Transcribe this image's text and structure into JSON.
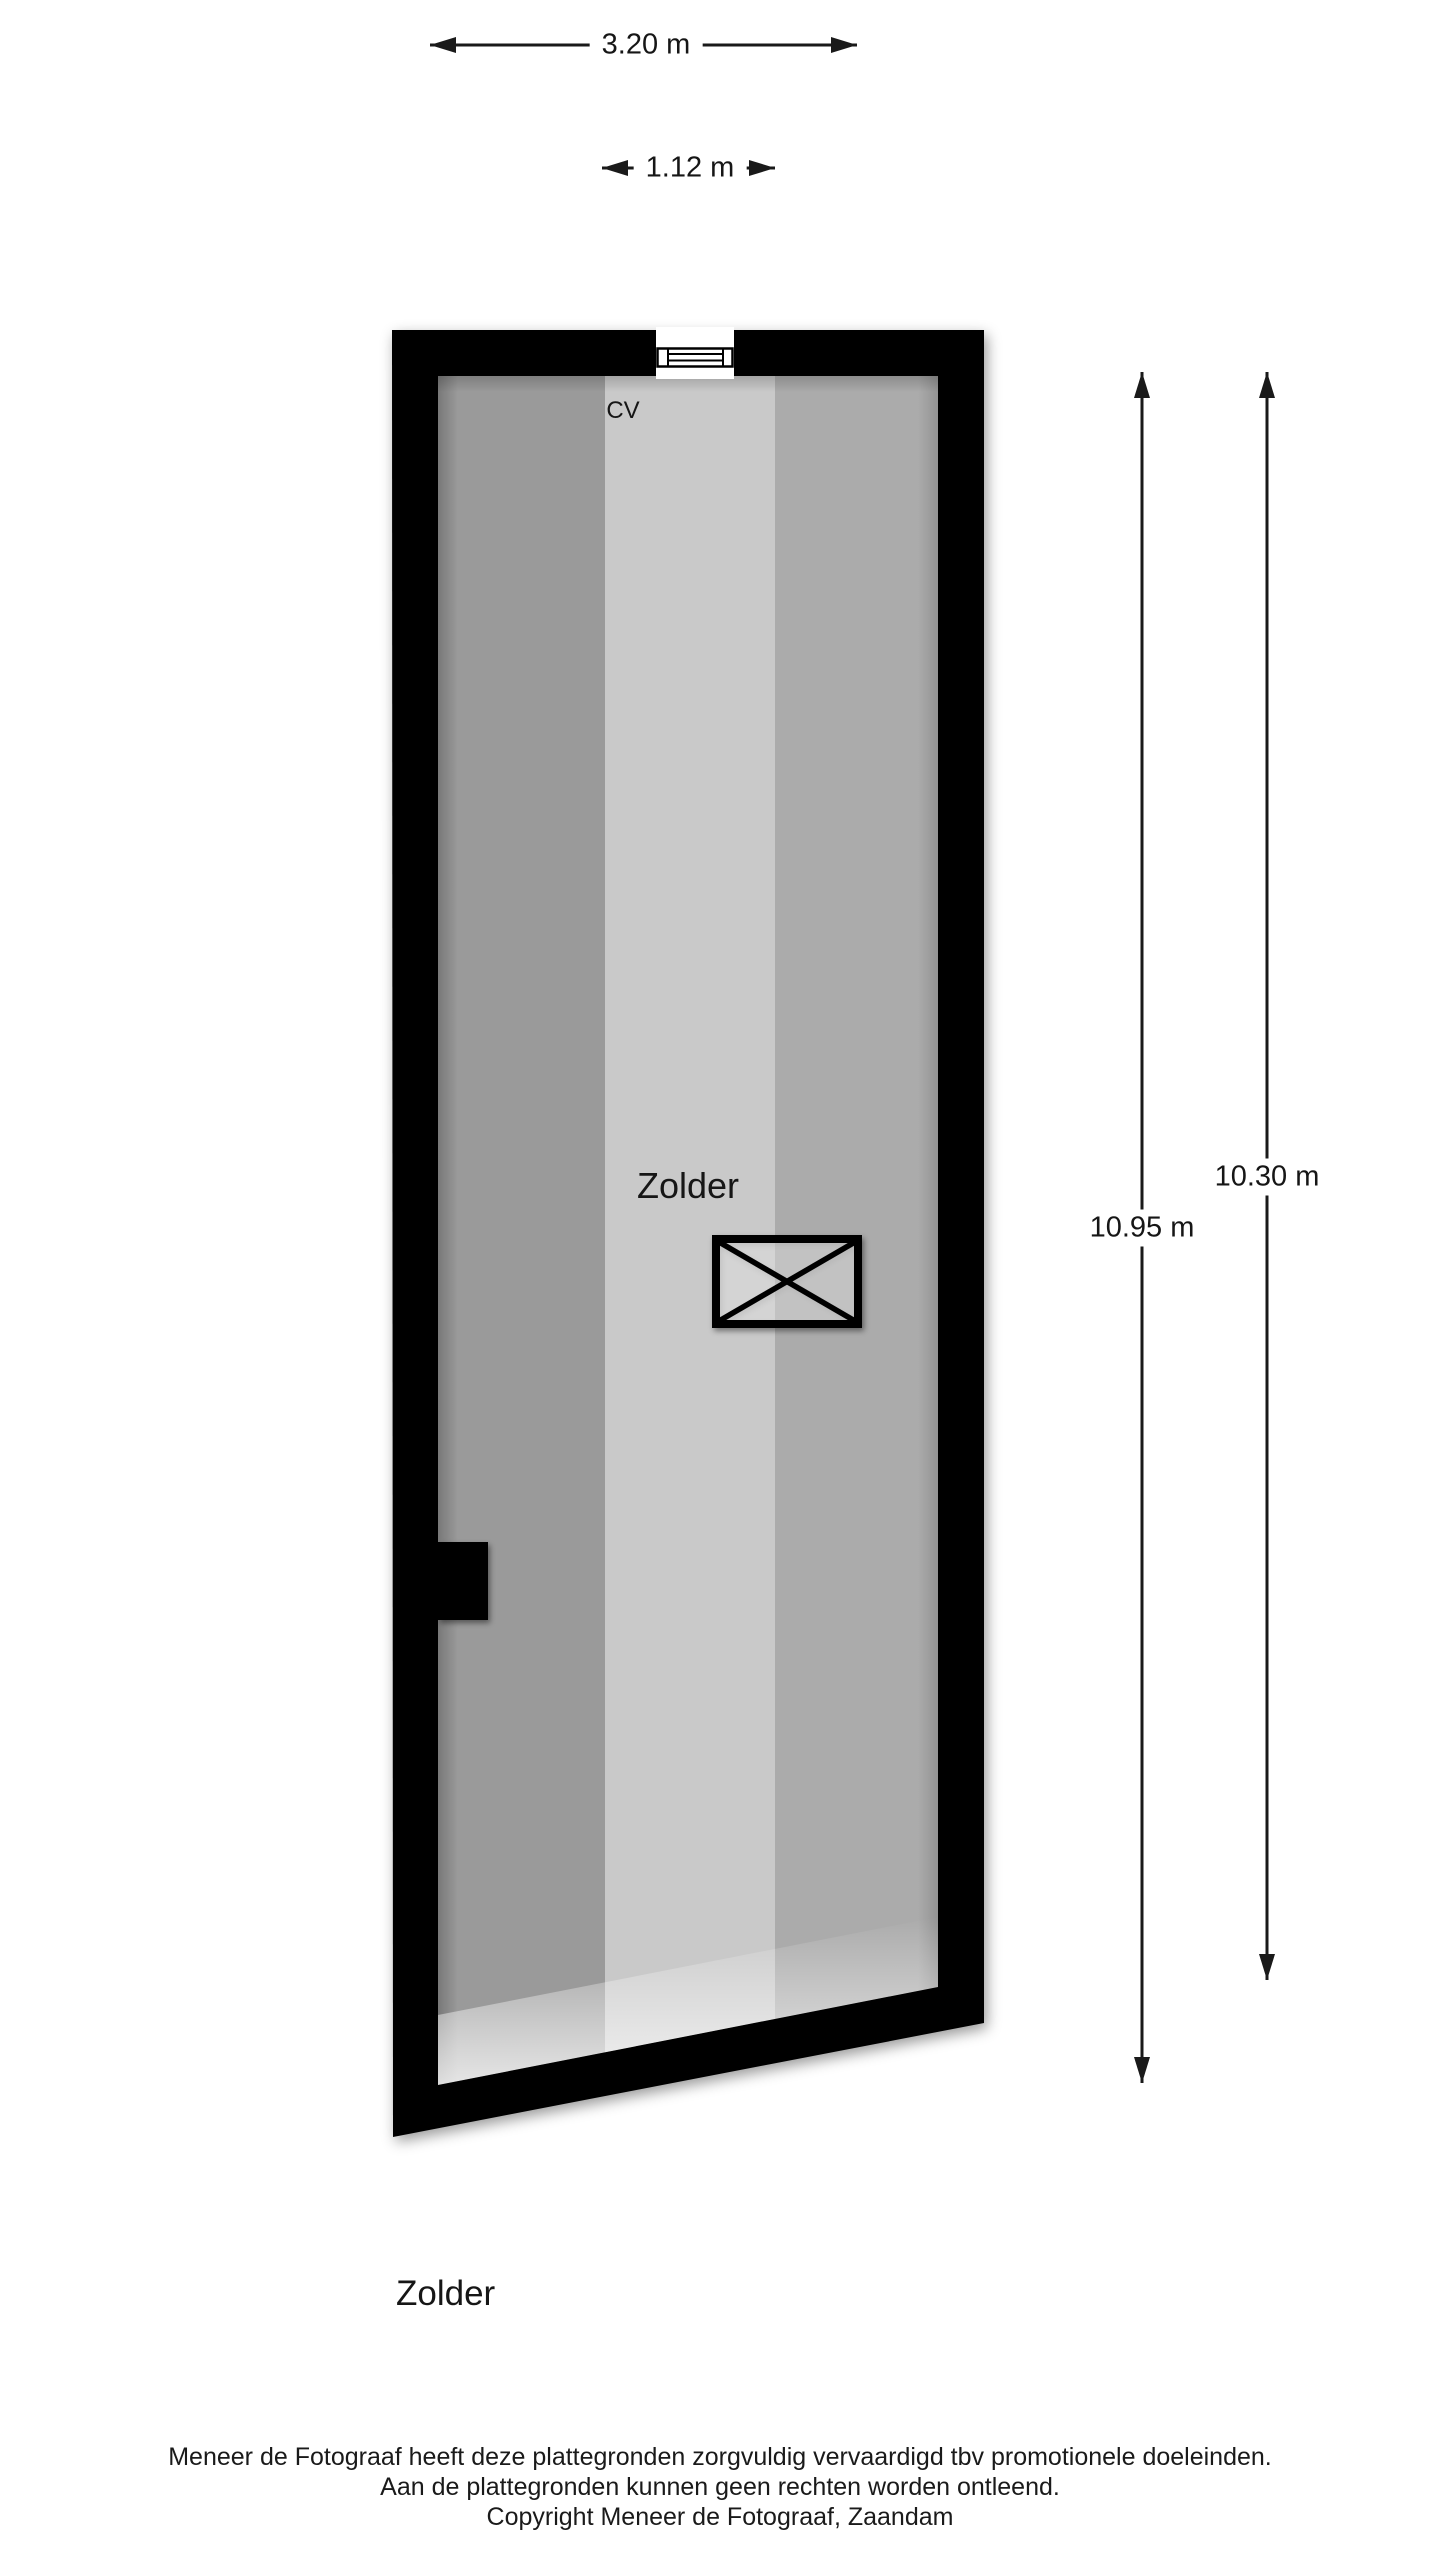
{
  "floorplan": {
    "room_label": "Zolder",
    "cv_label": "CV",
    "dimensions": {
      "width_total": "3.20 m",
      "width_window": "1.12 m",
      "height_left": "10.95 m",
      "height_right": "10.30 m"
    },
    "colors": {
      "wall": "#000000",
      "stripe_left": "#9a9a9a",
      "stripe_middle": "#c9c9c9",
      "stripe_right": "#ababab",
      "dimension_line": "#1a1a1a",
      "background": "#ffffff"
    }
  },
  "title": "Zolder",
  "footer": {
    "line1": "Meneer de Fotograaf heeft deze plattegronden zorgvuldig vervaardigd tbv promotionele doeleinden.",
    "line2": "Aan de plattegronden kunnen geen rechten worden ontleend.",
    "line3": "Copyright Meneer de Fotograaf, Zaandam"
  }
}
